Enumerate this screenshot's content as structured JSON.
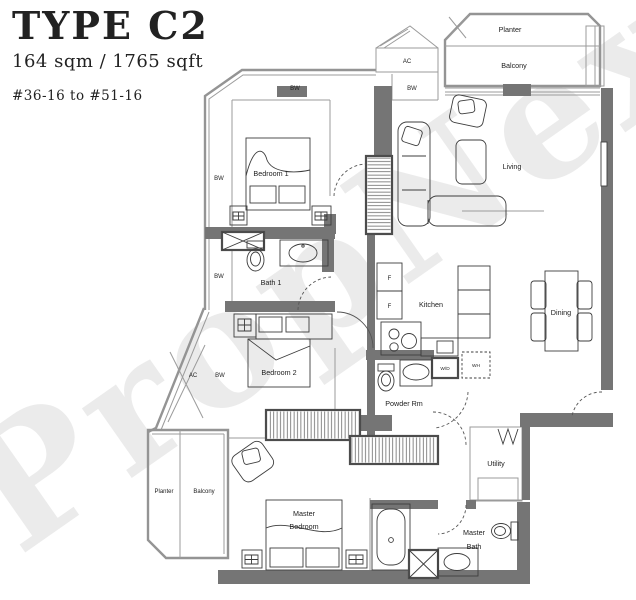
{
  "header": {
    "type": "TYPE C2",
    "area": "164 sqm / 1765 sqft",
    "unit_range": "#36-16 to #51-16"
  },
  "watermark": "PropNex",
  "labels": {
    "planter_top": "Planter",
    "balcony_top": "Balcony",
    "living": "Living",
    "dining": "Dining",
    "kitchen": "Kitchen",
    "bedroom1": "Bedroom 1",
    "bath1": "Bath 1",
    "bedroom2": "Bedroom 2",
    "powder": "Powder Rm",
    "utility": "Utility",
    "planter_left": "Planter",
    "balcony_left": "Balcony",
    "master_bedroom_l1": "Master",
    "master_bedroom_l2": "Bedroom",
    "master_bath_l1": "Master",
    "master_bath_l2": "Bath"
  },
  "markers": {
    "ac": "AC",
    "bw": "BW",
    "fridge": "F",
    "washer_dryer": "W/D",
    "water_heater": "WH"
  }
}
